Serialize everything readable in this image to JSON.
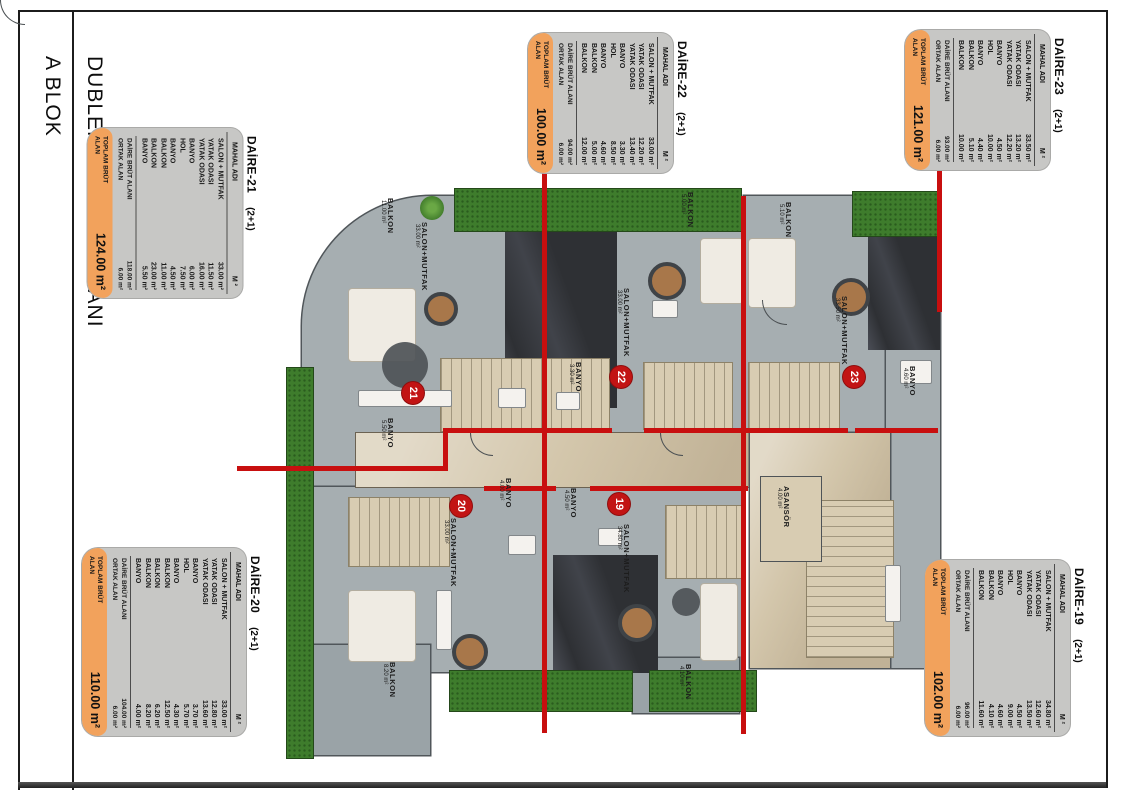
{
  "sheet": {
    "block_title": "A BLOK",
    "plan_title": "DUBLEKS ALT KAT PLANI"
  },
  "colors": {
    "accent_orange": "#F2A25C",
    "wall_red": "#C80F0F",
    "table_gray": "#C7C7C5",
    "grass_green": "#3E7C2C"
  },
  "tables": [
    {
      "name": "DAİRE-21",
      "type": "(2+1)",
      "col_room": "MAHAL ADI",
      "col_area": "M ²",
      "rows": [
        [
          "SALON + MUTFAK",
          "33.00 m²"
        ],
        [
          "YATAK ODASI",
          "11.50 m²"
        ],
        [
          "YATAK ODASI",
          "16.00 m²"
        ],
        [
          "BANYO",
          "6.00 m²"
        ],
        [
          "HOL",
          "7.50 m²"
        ],
        [
          "BANYO",
          "4.50 m²"
        ],
        [
          "BALKON",
          "11.00 m²"
        ],
        [
          "BALKON",
          "23.00 m²"
        ],
        [
          "BANYO",
          "5.50 m²"
        ]
      ],
      "brut_label": "DAİRE BRÜT ALANI",
      "brut": "118.00 m²",
      "ortak_label": "ORTAK ALAN",
      "ortak": "6.00 m²",
      "total_label": "TOPLAM BRÜT ALAN",
      "total": "124.00 m²"
    },
    {
      "name": "DAİRE-22",
      "type": "(2+1)",
      "col_room": "MAHAL ADI",
      "col_area": "M ²",
      "rows": [
        [
          "SALON + MUTFAK",
          "33.00 m²"
        ],
        [
          "YATAK ODASI",
          "12.20 m²"
        ],
        [
          "YATAK ODASI",
          "13.40 m²"
        ],
        [
          "BANYO",
          "3.30 m²"
        ],
        [
          "HOL",
          "8.50 m²"
        ],
        [
          "BANYO",
          "4.60 m²"
        ],
        [
          "BALKON",
          "5.00 m²"
        ],
        [
          "BALKON",
          "12.00 m²"
        ]
      ],
      "brut_label": "DAİRE BRÜT ALANI",
      "brut": "94.00 m²",
      "ortak_label": "ORTAK ALAN",
      "ortak": "6.00 m²",
      "total_label": "TOPLAM BRÜT ALAN",
      "total": "100.00 m²"
    },
    {
      "name": "DAİRE-23",
      "type": "(2+1)",
      "col_room": "MAHAL ADI",
      "col_area": "M ²",
      "rows": [
        [
          "SALON + MUTFAK",
          "33.50 m²"
        ],
        [
          "YATAK ODASI",
          "13.20 m²"
        ],
        [
          "YATAK ODASI",
          "12.20 m²"
        ],
        [
          "BANYO",
          "4.50 m²"
        ],
        [
          "HOL",
          "10.00 m²"
        ],
        [
          "BANYO",
          "4.40 m²"
        ],
        [
          "BALKON",
          "5.10 m²"
        ],
        [
          "BALKON",
          "10.00 m²"
        ]
      ],
      "brut_label": "DAİRE BRÜT ALANI",
      "brut": "93.00 m²",
      "ortak_label": "ORTAK ALAN",
      "ortak": "6.00 m²",
      "total_label": "TOPLAM BRÜT ALAN",
      "total": "121.00 m²"
    },
    {
      "name": "DAİRE-20",
      "type": "(2+1)",
      "col_room": "MAHAL ADI",
      "col_area": "M ²",
      "rows": [
        [
          "SALON + MUTFAK",
          "33.00 m²"
        ],
        [
          "YATAK ODASI",
          "12.80 m²"
        ],
        [
          "YATAK ODASI",
          "13.60 m²"
        ],
        [
          "BANYO",
          "3.70 m²"
        ],
        [
          "HOL",
          "5.70 m²"
        ],
        [
          "BANYO",
          "4.30 m²"
        ],
        [
          "BALKON",
          "12.50 m²"
        ],
        [
          "BALKON",
          "6.20 m²"
        ],
        [
          "BALKON",
          "8.20 m²"
        ],
        [
          "BANYO",
          "4.00 m²"
        ]
      ],
      "brut_label": "DAİRE BRÜT ALANI",
      "brut": "104.00 m²",
      "ortak_label": "ORTAK ALAN",
      "ortak": "6.00 m²",
      "total_label": "TOPLAM BRÜT ALAN",
      "total": "110.00 m²"
    },
    {
      "name": "DAİRE-19",
      "type": "(2+1)",
      "col_room": "MAHAL ADI",
      "col_area": "M ²",
      "rows": [
        [
          "SALON + MUTFAK",
          "34.80 m²"
        ],
        [
          "YATAK ODASI",
          "12.60 m²"
        ],
        [
          "YATAK ODASI",
          "13.50 m²"
        ],
        [
          "BANYO",
          "4.50 m²"
        ],
        [
          "HOL",
          "9.00 m²"
        ],
        [
          "BANYO",
          "4.60 m²"
        ],
        [
          "BALKON",
          "4.10 m²"
        ],
        [
          "BALKON",
          "11.60 m²"
        ]
      ],
      "brut_label": "DAİRE BRÜT ALANI",
      "brut": "96.00 m²",
      "ortak_label": "ORTAK ALAN",
      "ortak": "6.00 m²",
      "total_label": "TOPLAM BRÜT ALAN",
      "total": "102.00 m²"
    }
  ],
  "plan": {
    "rooms": [
      {
        "name": "SALON+MUTFAK",
        "area": "33.00 m²"
      },
      {
        "name": "SALON+MUTFAK",
        "area": "33.00 m²"
      },
      {
        "name": "SALON+MUTFAK",
        "area": "33.50 m²"
      },
      {
        "name": "SALON+MUTFAK",
        "area": "33.00 m²"
      },
      {
        "name": "SALON+MUTFAK",
        "area": "34.80 m²"
      },
      {
        "name": "BANYO",
        "area": "5.50 m²"
      },
      {
        "name": "BANYO",
        "area": "3.30 m²"
      },
      {
        "name": "BANYO",
        "area": "4.60 m²"
      },
      {
        "name": "BANYO",
        "area": "4.00 m²"
      },
      {
        "name": "BANYO",
        "area": "4.50 m²"
      },
      {
        "name": "ASANSÖR",
        "area": "4.00 m²"
      },
      {
        "name": "BALKON",
        "area": "11.00 m²"
      },
      {
        "name": "BALKON",
        "area": "5.00 m²"
      },
      {
        "name": "BALKON",
        "area": "5.10 m²"
      },
      {
        "name": "BALKON",
        "area": "8.20 m²"
      },
      {
        "name": "BALKON",
        "area": "4.10 m²"
      }
    ],
    "unit_badges": [
      "21",
      "22",
      "23",
      "20",
      "19"
    ]
  }
}
